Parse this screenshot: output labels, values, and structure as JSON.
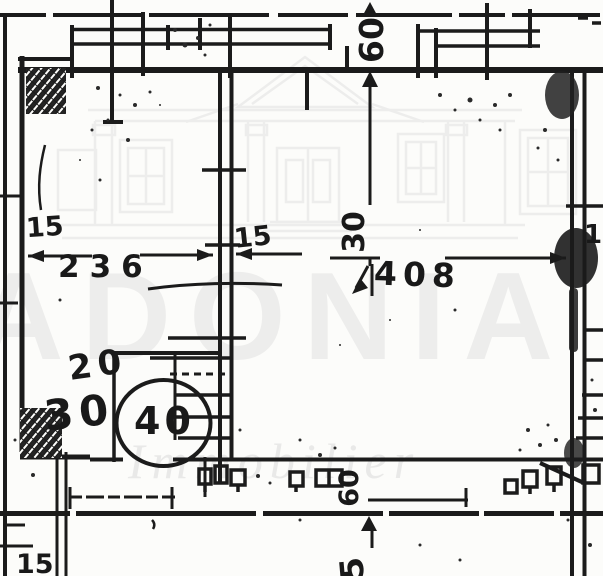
{
  "watermark": {
    "brand": "ADONIA",
    "tagline": "Immobilier"
  },
  "colors": {
    "ink": "#1b1b1b",
    "paper": "#fcfcfa",
    "watermark_gray": "#ededec"
  },
  "labels": {
    "top_band_depth": "60",
    "left_wall_thickness": "15",
    "left_room_width": "236",
    "middle_wall_thickness": "15",
    "right_room_width": "408",
    "middle_vertical_dim": "30",
    "right_wall_thickness": "15",
    "stair_dim_a": "20",
    "stair_dim_b": "30",
    "stair_dim_circled": "40",
    "bottom_band_depth": "60",
    "bottom_vertical_partial": "5",
    "bottom_left_wall": "15"
  }
}
